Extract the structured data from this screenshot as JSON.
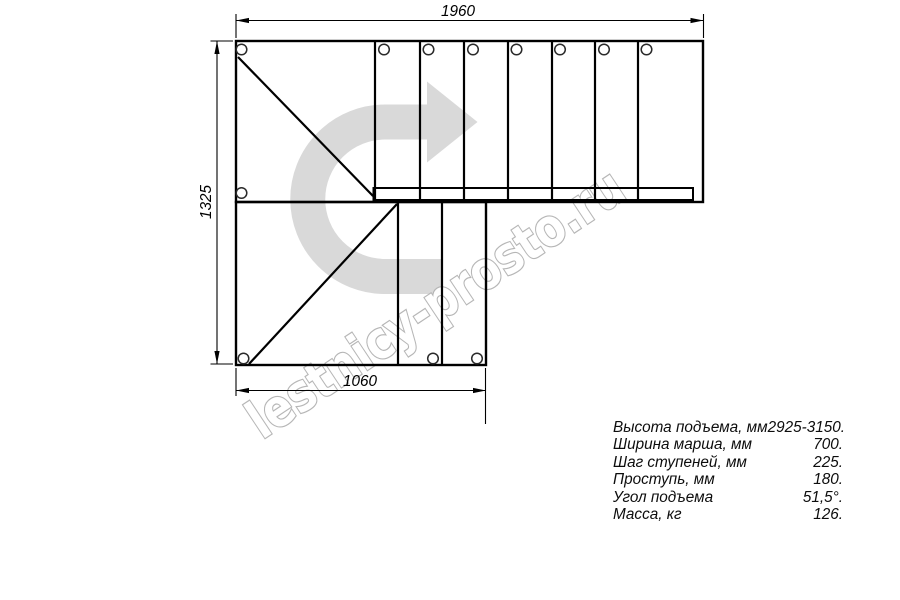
{
  "colors": {
    "background": "#ffffff",
    "line": "#000000",
    "arrow_gray": "#d9d9d9",
    "watermark_gray": "#b3b3b3"
  },
  "drawing": {
    "dim_top": "1960",
    "dim_left": "1325",
    "dim_bottom": "1060",
    "watermark_text": "lestnicy-prosto.ru"
  },
  "specs": {
    "rows": [
      {
        "label": "Высота подъема, мм",
        "value": "2925-3150."
      },
      {
        "label": "Ширина марша, мм",
        "value": "700."
      },
      {
        "label": "Шаг ступеней, мм",
        "value": "225."
      },
      {
        "label": "Проступь, мм",
        "value": "180."
      },
      {
        "label": "Угол подъема",
        "value": "51,5°."
      },
      {
        "label": "Масса, кг",
        "value": "126."
      }
    ]
  }
}
